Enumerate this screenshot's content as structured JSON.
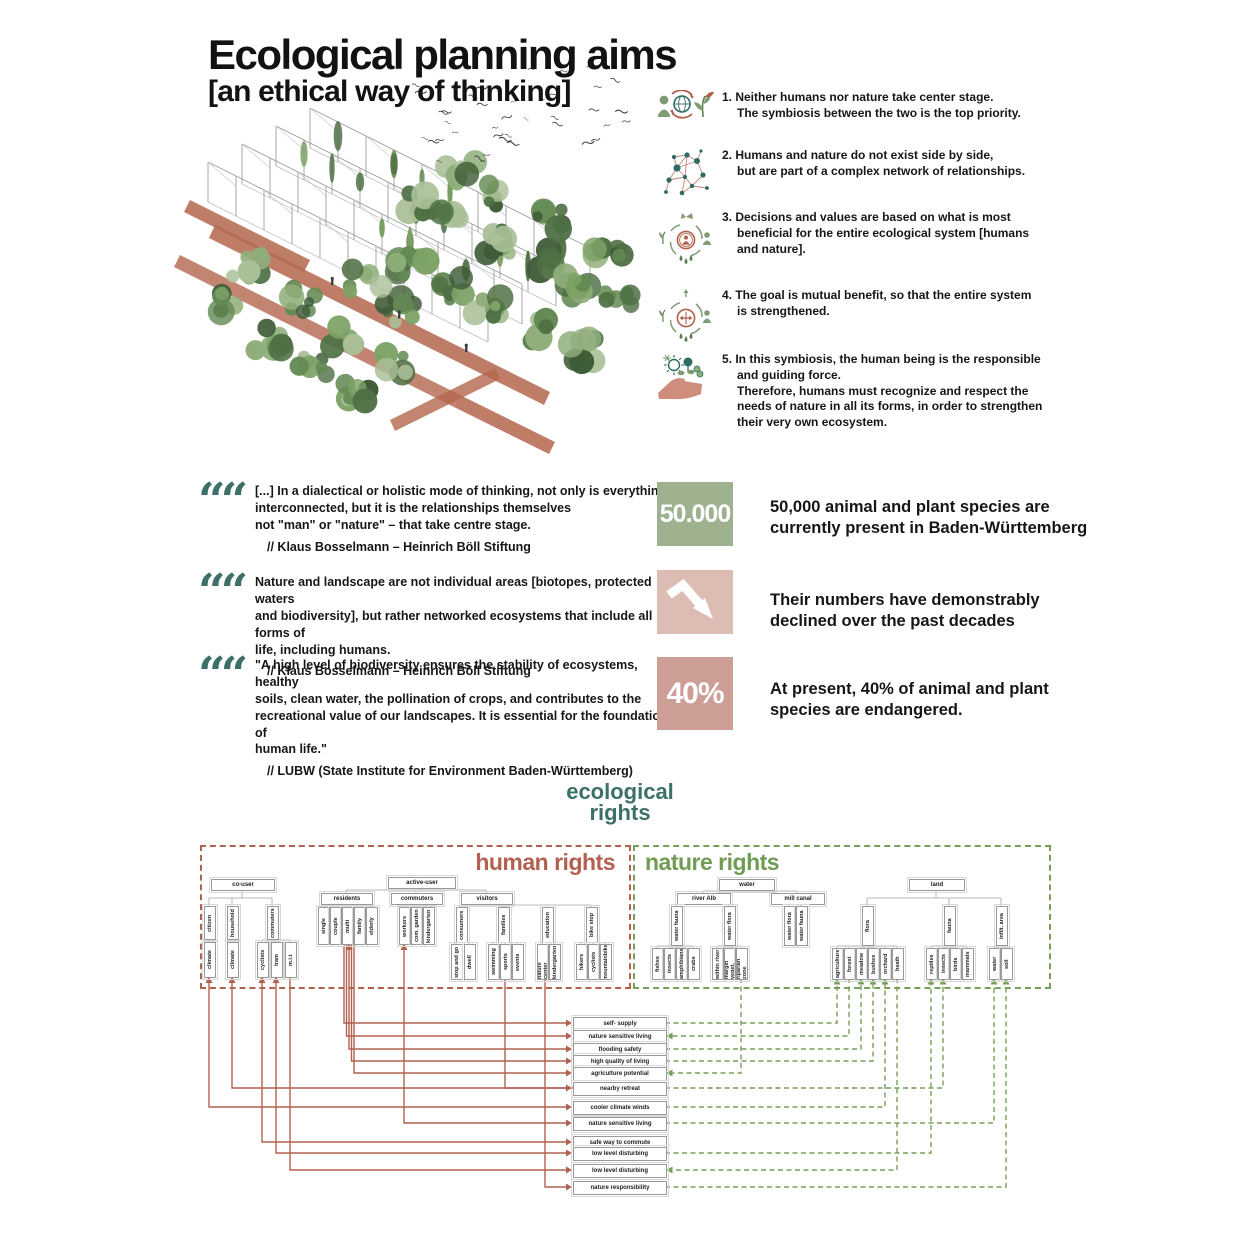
{
  "title": {
    "main": "Ecological planning aims",
    "sub": "[an ethical way of thinking]"
  },
  "colors": {
    "teal": "#3d7068",
    "human_red": "#b2604f",
    "nature_green": "#77a058",
    "stat_green": "#9eb290",
    "stat_pink_light": "#ddbcb4",
    "stat_pink_dark": "#cc9e95",
    "connector_grey": "#a3a3a3",
    "icon_green": "#7f9c72",
    "icon_teal": "#2e6b63",
    "icon_red": "#b2604c"
  },
  "principles": [
    {
      "icon": "humans-globe-plant-icon",
      "text": "1. Neither humans nor nature take center stage.\nThe symbiosis between the two is the top priority."
    },
    {
      "icon": "network-icon",
      "text": "2. Humans and nature do not exist side by side,\nbut are part of a complex network of relationships."
    },
    {
      "icon": "ecosystem-evaluation-icon",
      "text": "3. Decisions and values are based on what is most\nbeneficial for the entire ecological system [humans\nand nature]."
    },
    {
      "icon": "mutual-benefit-icon",
      "text": "4. The goal is mutual benefit, so that the entire system\nis strengthened."
    },
    {
      "icon": "responsibility-hand-icon",
      "text": "5. In this symbiosis, the human being is the responsible\nand guiding force.\nTherefore, humans must recognize and respect the\nneeds of nature in all its forms, in order to strengthen\ntheir very own ecosystem."
    }
  ],
  "quotes": [
    {
      "text": "[...] In a dialectical or holistic mode of thinking, not only is everything\ninterconnected, but it is the relationships themselves\nnot \"man\" or \"nature\" – that take centre stage.",
      "attribution": "// Klaus Bosselmann – Heinrich Böll Stiftung"
    },
    {
      "text": "Nature and landscape are not individual areas [biotopes, protected waters\nand biodiversity], but rather networked ecosystems that include all forms of\nlife, including humans.",
      "attribution": "// Klaus Bosselmann – Heinrich Böll Stiftung"
    },
    {
      "text": "\"A high level of biodiversity ensures the stability of ecosystems, healthy\nsoils, clean water, the pollination of crops, and contributes to the\nrecreational value of our landscapes. It is essential for the foundations of\nhuman life.\"",
      "attribution": "// LUBW (State Institute for Environment Baden-Württemberg)"
    }
  ],
  "stats": [
    {
      "value": "50.000",
      "icon": "",
      "text": "50,000 animal and plant species are\ncurrently present in Baden-Württemberg"
    },
    {
      "value": "",
      "icon": "trend-down-arrow-icon",
      "text": "Their numbers have demonstrably\ndeclined over the past decades"
    },
    {
      "value": "40%",
      "icon": "",
      "text": "At present, 40% of animal and plant\nspecies are endangered."
    }
  ],
  "diagram": {
    "title_line1": "ecological",
    "title_line2": "rights",
    "human_label": "human rights",
    "nature_label": "nature rights",
    "human_nodes": [
      "co-user",
      "active-user",
      "residents",
      "commuters",
      "visitors",
      "citizen",
      "household",
      "commuters",
      "climate",
      "climate",
      "cyclists",
      "tram",
      "m.i.t",
      "single",
      "couple",
      "multi",
      "family",
      "elderly",
      "workers",
      "com. garden",
      "kindergarten",
      "consumers",
      "families",
      "education",
      "bike stop",
      "stop and go",
      "dwell",
      "swimming",
      "sports",
      "events",
      "nature center",
      "kindergarten",
      "hikers",
      "cyclists",
      "mountainbike"
    ],
    "nature_nodes": [
      "water",
      "river Alb",
      "mill canal",
      "land",
      "water fauna",
      "water flora",
      "fishes",
      "insects",
      "amphibians",
      "crabs",
      "within river",
      "margin veget.",
      "riparian zone",
      "water flora",
      "water fauna",
      "flora",
      "fauna",
      "infilt. area",
      "agriculture",
      "forest",
      "meadow",
      "bushes",
      "orchard",
      "heath",
      "reptiles",
      "insects",
      "birds",
      "mammals",
      "water",
      "soil"
    ],
    "relations": [
      "self- supply",
      "nature sensitive living",
      "flooding safety",
      "high quality of living",
      "agriculture potential",
      "nearby retreat",
      "cooler climate winds",
      "nature sensitive living",
      "safe way to commute",
      "low level disturbing",
      "low level disturbing",
      "nature responsibility"
    ]
  }
}
